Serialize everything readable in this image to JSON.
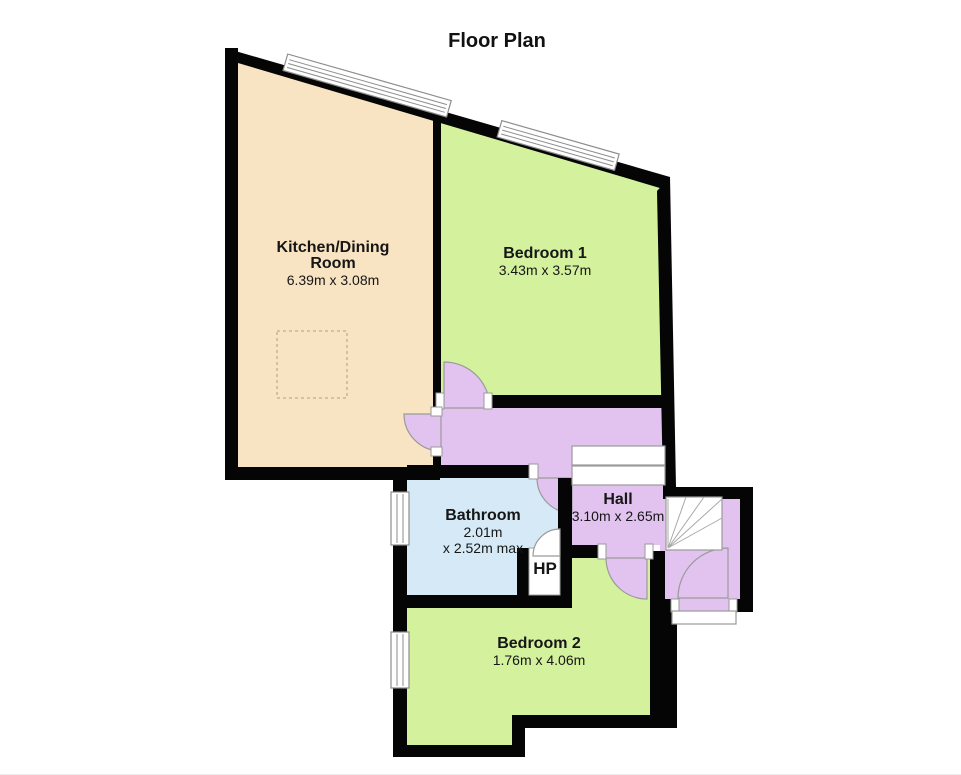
{
  "title": "Floor Plan",
  "colors": {
    "kitchen": "#F8E4C3",
    "bedroom": "#D4F29D",
    "bathroom": "#D5EAF6",
    "hall": "#E2C3EF",
    "wall": "#050505"
  },
  "rooms": {
    "kitchen": {
      "name_line1": "Kitchen/Dining",
      "name_line2": "Room",
      "dims": "6.39m x 3.08m"
    },
    "bedroom1": {
      "name": "Bedroom 1",
      "dims": "3.43m x 3.57m"
    },
    "bathroom": {
      "name": "Bathroom",
      "dims_line1": "2.01m",
      "dims_line2": "x 2.52m max"
    },
    "hall": {
      "name": "Hall",
      "dims": "3.10m x 2.65m"
    },
    "bedroom2": {
      "name": "Bedroom 2",
      "dims": "1.76m x 4.06m"
    },
    "hot_press": {
      "name": "HP"
    }
  }
}
